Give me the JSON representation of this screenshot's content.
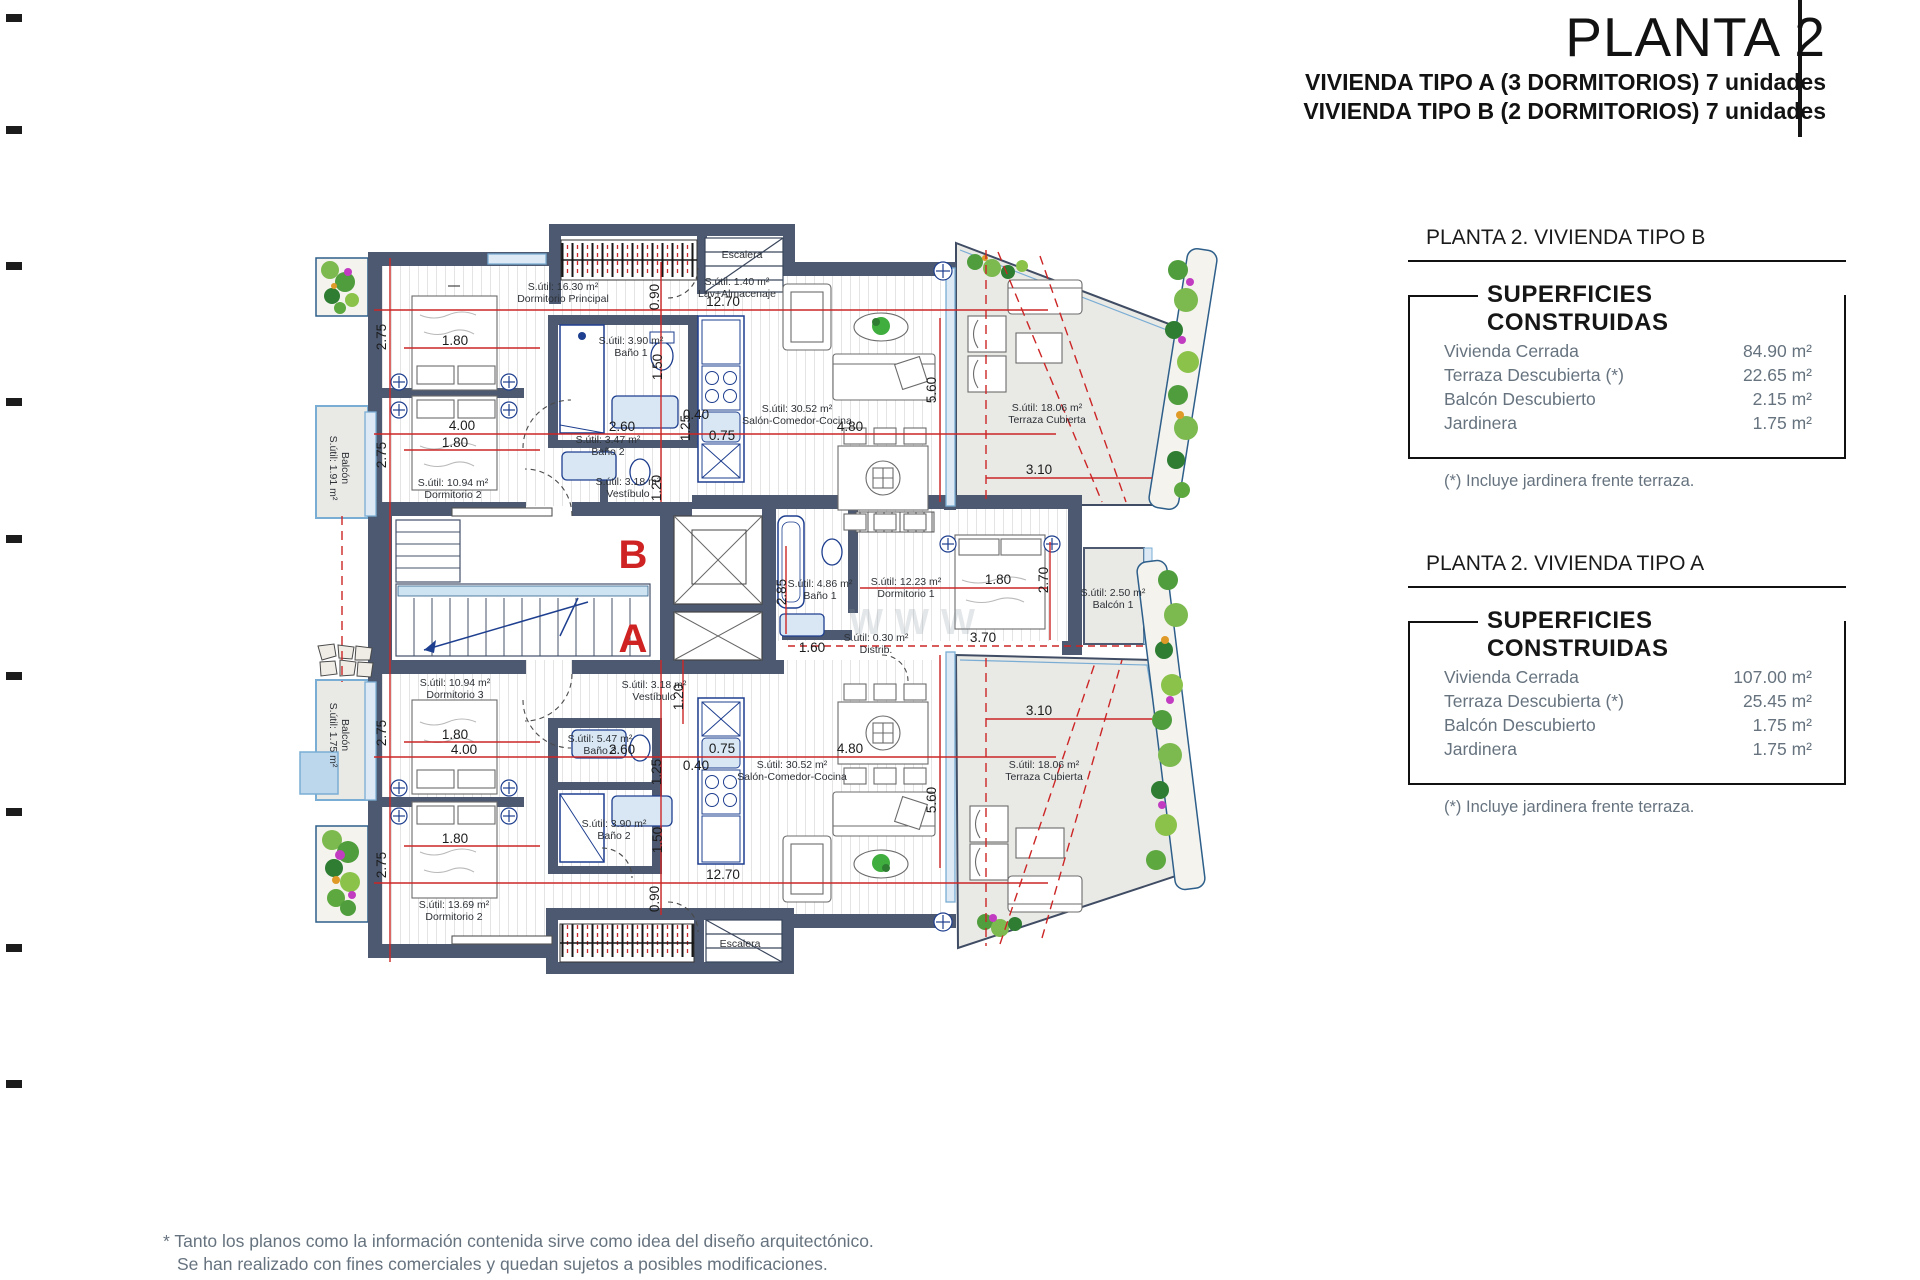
{
  "page": {
    "title": "PLANTA 2",
    "subtitle1": "VIVIENDA TIPO A (3 DORMITORIOS) 7 unidades",
    "subtitle2": "VIVIENDA TIPO B (2 DORMITORIOS) 7 unidades",
    "footnote_line1": "* Tanto los planos como la información contenida sirve como idea del diseño arquitectónico.",
    "footnote_line2": "Se han realizado con fines comerciales y quedan sujetos a posibles modificaciones."
  },
  "tables": [
    {
      "header": "PLANTA 2. VIVIENDA TIPO B",
      "box_title": "SUPERFICIES CONSTRUIDAS",
      "rows": [
        [
          "Vivienda Cerrada",
          "84.90 m²"
        ],
        [
          "Terraza Descubierta (*)",
          "22.65 m²"
        ],
        [
          "Balcón Descubierto",
          "2.15 m²"
        ],
        [
          "Jardinera",
          "1.75 m²"
        ]
      ],
      "note": "(*) Incluye jardinera frente terraza."
    },
    {
      "header": "PLANTA 2. VIVIENDA TIPO A",
      "box_title": "SUPERFICIES CONSTRUIDAS",
      "rows": [
        [
          "Vivienda Cerrada",
          "107.00 m²"
        ],
        [
          "Terraza Descubierta (*)",
          "25.45 m²"
        ],
        [
          "Balcón Descubierto",
          "1.75 m²"
        ],
        [
          "Jardinera",
          "1.75 m²"
        ]
      ],
      "note": "(*) Incluye jardinera frente terraza."
    }
  ],
  "plan": {
    "letters": [
      {
        "t": "B",
        "x": 633,
        "y": 568
      },
      {
        "t": "A",
        "x": 633,
        "y": 652
      }
    ],
    "rooms": [
      {
        "l1": "S.útil: 16.30 m²",
        "l2": "Dormitorio Principal",
        "x": 563,
        "y": 290
      },
      {
        "l1": "S.útil: 3.90 m²",
        "l2": "Baño 1",
        "x": 631,
        "y": 344
      },
      {
        "l1": "S.útil: 1.40 m²",
        "l2": "Lav+Almacenaje",
        "x": 737,
        "y": 285
      },
      {
        "l1": "S.útil: 30.52 m²",
        "l2": "Salón-Comedor-Cocina",
        "x": 797,
        "y": 412
      },
      {
        "l1": "S.útil: 18.06 m²",
        "l2": "Terraza Cubierta",
        "x": 1047,
        "y": 411
      },
      {
        "l1": "S.útil: 10.94 m²",
        "l2": "Dormitorio 2",
        "x": 453,
        "y": 486
      },
      {
        "l1": "S.útil: 3.47 m²",
        "l2": "Baño 2",
        "x": 608,
        "y": 443
      },
      {
        "l1": "S.útil: 3.18 m²",
        "l2": "Vestíbulo",
        "x": 628,
        "y": 485
      },
      {
        "l1": "Balcón",
        "l2": "S.útil: 1.91 m²",
        "x": 342,
        "y": 468,
        "rot": 90
      },
      {
        "l1": "S.útil: 10.94 m²",
        "l2": "Dormitorio 3",
        "x": 455,
        "y": 686
      },
      {
        "l1": "S.útil: 3.18 m²",
        "l2": "Vestíbulo",
        "x": 654,
        "y": 688
      },
      {
        "l1": "S.útil: 5.47 m²",
        "l2": "Baño 3",
        "x": 600,
        "y": 742
      },
      {
        "l1": "S.útil: 3.90 m²",
        "l2": "Baño 2",
        "x": 614,
        "y": 827
      },
      {
        "l1": "S.útil: 13.69 m²",
        "l2": "Dormitorio 2",
        "x": 454,
        "y": 908
      },
      {
        "l1": "S.útil: 30.52 m²",
        "l2": "Salón-Comedor-Cocina",
        "x": 792,
        "y": 768
      },
      {
        "l1": "S.útil: 18.06 m²",
        "l2": "Terraza Cubierta",
        "x": 1044,
        "y": 768
      },
      {
        "l1": "S.útil: 12.23 m²",
        "l2": "Dormitorio 1",
        "x": 906,
        "y": 585
      },
      {
        "l1": "S.útil: 4.86 m²",
        "l2": "Baño 1",
        "x": 820,
        "y": 587
      },
      {
        "l1": "S.útil: 0.30 m²",
        "l2": "Distrib.",
        "x": 876,
        "y": 641
      },
      {
        "l1": "S.útil: 2.50 m²",
        "l2": "Balcón 1",
        "x": 1113,
        "y": 596
      },
      {
        "l1": "Balcón",
        "l2": "S.útil: 1.75 m²",
        "x": 342,
        "y": 735,
        "rot": 90
      }
    ],
    "dims": [
      {
        "t": "12.70",
        "x": 723,
        "y": 306
      },
      {
        "t": "0.90",
        "x": 659,
        "y": 297,
        "rot": 1
      },
      {
        "t": "2.75",
        "x": 386,
        "y": 337,
        "rot": 1
      },
      {
        "t": "2.75",
        "x": 386,
        "y": 455,
        "rot": 1
      },
      {
        "t": "1.80",
        "x": 455,
        "y": 345
      },
      {
        "t": "1.50",
        "x": 662,
        "y": 367,
        "rot": 1
      },
      {
        "t": "1.25",
        "x": 690,
        "y": 428,
        "rot": 1
      },
      {
        "t": "4.00",
        "x": 462,
        "y": 430
      },
      {
        "t": "2.60",
        "x": 622,
        "y": 431
      },
      {
        "t": "0.40",
        "x": 696,
        "y": 419
      },
      {
        "t": "0.75",
        "x": 722,
        "y": 440
      },
      {
        "t": "1.80",
        "x": 455,
        "y": 447
      },
      {
        "t": "1.20",
        "x": 661,
        "y": 488,
        "rot": 1
      },
      {
        "t": "5.60",
        "x": 936,
        "y": 390,
        "rot": 1
      },
      {
        "t": "4.80",
        "x": 850,
        "y": 431
      },
      {
        "t": "3.10",
        "x": 1039,
        "y": 474
      },
      {
        "t": "2.85",
        "x": 786,
        "y": 592,
        "rot": 1
      },
      {
        "t": "1.80",
        "x": 998,
        "y": 584
      },
      {
        "t": "2.70",
        "x": 1048,
        "y": 580,
        "rot": 1
      },
      {
        "t": "1.60",
        "x": 812,
        "y": 652
      },
      {
        "t": "3.70",
        "x": 983,
        "y": 642
      },
      {
        "t": "1.20",
        "x": 683,
        "y": 697,
        "rot": 1
      },
      {
        "t": "2.75",
        "x": 386,
        "y": 733,
        "rot": 1
      },
      {
        "t": "1.80",
        "x": 455,
        "y": 739
      },
      {
        "t": "4.00",
        "x": 464,
        "y": 754
      },
      {
        "t": "2.60",
        "x": 622,
        "y": 754
      },
      {
        "t": "0.75",
        "x": 722,
        "y": 753
      },
      {
        "t": "0.40",
        "x": 696,
        "y": 770
      },
      {
        "t": "1.25",
        "x": 661,
        "y": 772,
        "rot": 1
      },
      {
        "t": "1.50",
        "x": 662,
        "y": 840,
        "rot": 1
      },
      {
        "t": "1.80",
        "x": 455,
        "y": 843
      },
      {
        "t": "2.75",
        "x": 386,
        "y": 865,
        "rot": 1
      },
      {
        "t": "12.70",
        "x": 723,
        "y": 879
      },
      {
        "t": "0.90",
        "x": 659,
        "y": 899,
        "rot": 1
      },
      {
        "t": "4.80",
        "x": 850,
        "y": 753
      },
      {
        "t": "5.60",
        "x": 936,
        "y": 800,
        "rot": 1
      },
      {
        "t": "3.10",
        "x": 1039,
        "y": 715
      }
    ],
    "misc": [
      {
        "t": "Escalera",
        "x": 742,
        "y": 258,
        "cls": "esc"
      },
      {
        "t": "Escalera",
        "x": 740,
        "y": 947,
        "cls": "esc"
      },
      {
        "t": "WWW",
        "x": 918,
        "y": 634,
        "cls": "wm"
      }
    ]
  }
}
